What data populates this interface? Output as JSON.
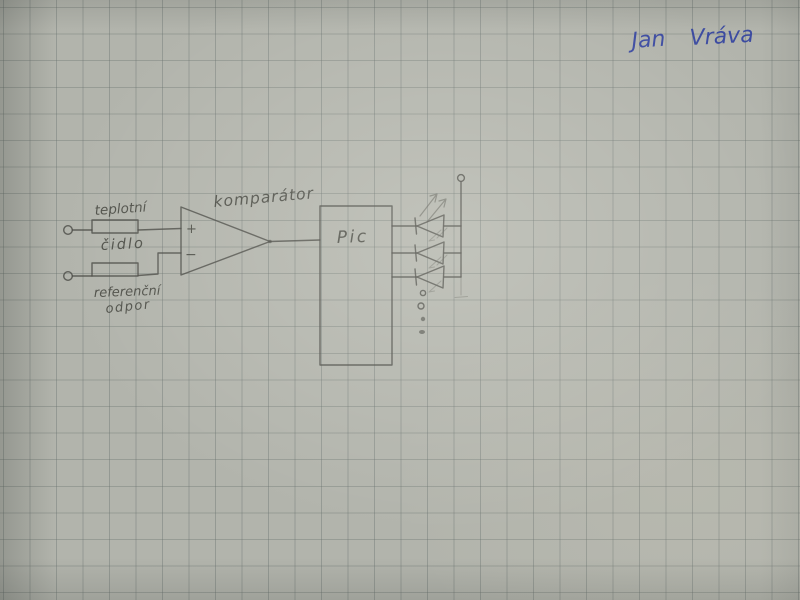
{
  "scene": {
    "description": "Photograph of a hand-drawn electronics schematic sketched in pencil on gray squared graph paper",
    "paper_color": "#b2b4ac",
    "grid_color": "#646c6a",
    "pencil_color": "#4a4b45",
    "ink_color": "#32429f"
  },
  "signature": {
    "first_name": "Jan",
    "last_name": "Vráva"
  },
  "schematic": {
    "sensor": {
      "label_top": "teplotní",
      "label_bottom": "čidlo",
      "symbol": "resistor"
    },
    "reference": {
      "label_line1": "referenční",
      "label_line2": "odpor",
      "symbol": "resistor"
    },
    "comparator": {
      "label": "komparátor",
      "plus_input": "+",
      "minus_input": "−"
    },
    "mcu": {
      "label": "Pic"
    },
    "leds": {
      "count": 3,
      "continuation_dots": 4
    },
    "terminals": {
      "input_count": 2,
      "supply_count": 1
    }
  }
}
